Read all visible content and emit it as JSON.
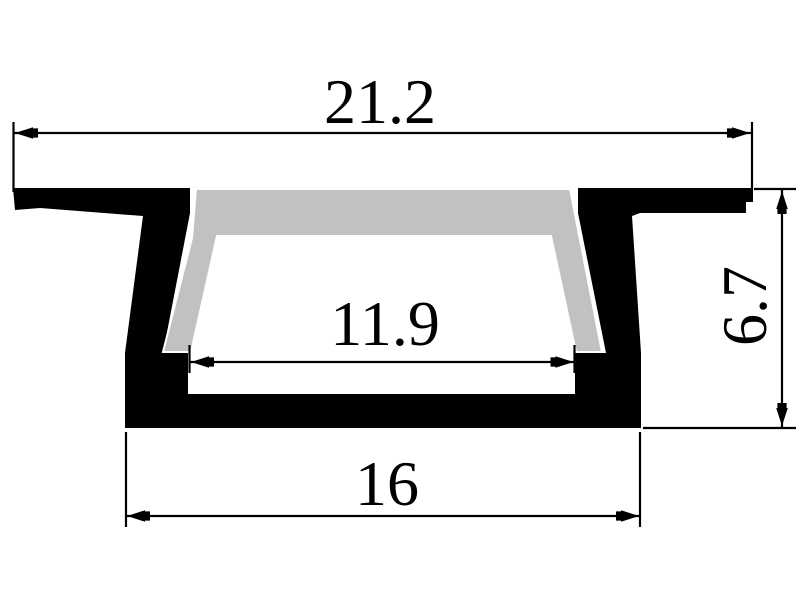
{
  "colors": {
    "line": "#000000",
    "profile": "#000000",
    "diffuser": "#c1c1c1",
    "background": "#ffffff"
  },
  "dimensions": {
    "overall_width": {
      "value": "21.2",
      "orientation": "horizontal",
      "position": "top"
    },
    "opening_width": {
      "value": "11.9",
      "orientation": "horizontal",
      "position": "middle"
    },
    "base_width": {
      "value": "16",
      "orientation": "horizontal",
      "position": "bottom"
    },
    "height": {
      "value": "6.7",
      "orientation": "vertical",
      "position": "right"
    }
  }
}
